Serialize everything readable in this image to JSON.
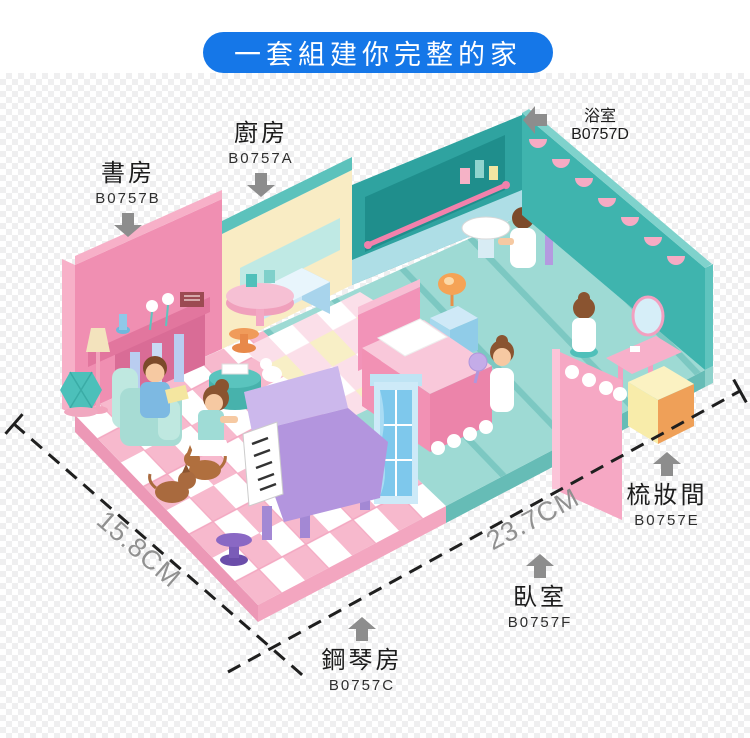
{
  "banner": {
    "text": "一套組建你完整的家"
  },
  "labels": [
    {
      "room": "kitchen",
      "name": "廚房",
      "code": "B0757A",
      "arrow": "down"
    },
    {
      "room": "study",
      "name": "書房",
      "code": "B0757B",
      "arrow": "down"
    },
    {
      "room": "piano-room",
      "name": "鋼琴房",
      "code": "B0757C",
      "arrow": "up"
    },
    {
      "room": "bathroom",
      "name": "浴室",
      "code": "B0757D",
      "arrow": "left"
    },
    {
      "room": "dressing-room",
      "name": "梳妝間",
      "code": "B0757E",
      "arrow": "up"
    },
    {
      "room": "bedroom",
      "name": "臥室",
      "code": "B0757F",
      "arrow": "up"
    }
  ],
  "dimensions": {
    "depth_label": "15.8CM",
    "width_label": "23.7CM"
  },
  "colors": {
    "banner_blue": "#1577e8",
    "label_text": "#1c1c1c",
    "code_text": "#2e2e2e",
    "arrow_gray": "#8d8d8d",
    "dimension_text": "#909090",
    "dash_line": "#1f1f1f",
    "pink_wall": "#f08fb2",
    "pink_floor": "#f7b9cd",
    "teal_floor": "#9edad4",
    "teal_wall": "#3fb4ae",
    "dark_teal_wall": "#2fa3a0",
    "cream_wall": "#f9ecc4",
    "piano_purple": "#b395de",
    "accent_blue": "#7ec8ec"
  }
}
